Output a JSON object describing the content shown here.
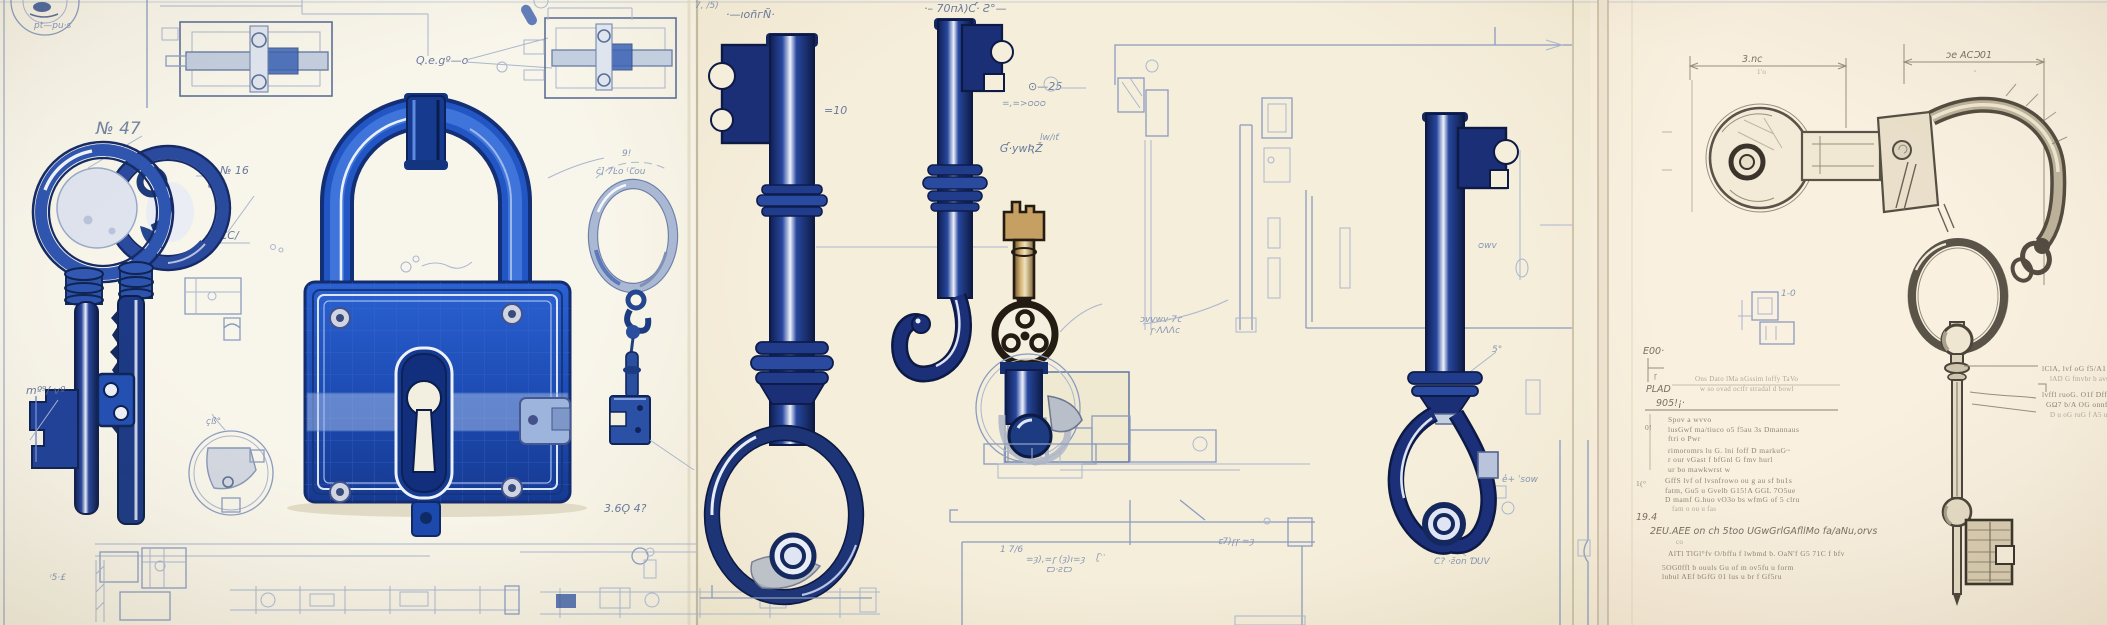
{
  "title": "Blueprint-style technical illustration of antique keys, padlock and key clasp",
  "palette": {
    "paper_left": "#f7f4ea",
    "paper_mid": "#f4edd9",
    "paper_right": "#f8efdf",
    "cobalt": "#2256c4",
    "cobalt_dark": "#16398f",
    "navy": "#1c2f74",
    "pencil_blue": "#8b9cc0",
    "pencil_dark": "#5d7096",
    "graphite": "#5a5348",
    "sepia_ink": "#241c12",
    "sepia_tan": "#c69f63"
  },
  "annotations": {
    "left": {
      "circle_note": "pt—pu·s",
      "no47": "№ 47",
      "qeg": "Q.e.gº—o",
      "no16": "№ 16",
      "occ": "‹o CC/",
      "detail_note": "çß°",
      "m2v": "mº⁹/ vº",
      "bottom_note": "ᵎ5·£"
    },
    "strip": {
      "ring_top": "c̄]·7Ŀo ⁽Ꞇou",
      "ring_mark": "9!",
      "key_tag": "3.6Ǫ 4?"
    },
    "middle": {
      "ts1": "7, /5)",
      "ts1b": "·—ıoñгÑ·",
      "ts2": "·– 70пλ)Ƈ· Ƨ°—",
      "eq10": "=10",
      "circ25": "⊙—25",
      "ouno": "=‚=>ᴑᴑᴑ",
      "cyw_top": "lw/ıť",
      "cyw": "Ɠ·ywƦŽ",
      "leader1": "ɔvvwv·7ꞇ",
      "leader2": "ꞅ·ɅɅɅϲ",
      "owv": "ᴑwv",
      "deg5": "5°",
      "esow": "e̓+ ˈsow",
      "cdov": "C? ·ƨ̈on ƊUV",
      "b1": "1 7/6",
      "b2": "=ȝ)‚=ꞅ (ȝ)ı=ȝ",
      "b3": "ꞇɔ·ƨꞇɔ",
      "b4": "ꞇ7)ꞅꞅ =ȝ",
      "b5": "ꞅ̱··"
    },
    "right": {
      "dim_left": "3.nc",
      "dim_left2": "1'o",
      "dim_right": "ɔe ACƆ01",
      "dim_tick": "ᵃ",
      "box_label": "1-0",
      "e00": "E00·",
      "dim5": "ꞅ",
      "plad": "PLAD",
      "p905": "905!¡·",
      "head1": "Ons Dato lMa nGssim loffy TaVo",
      "head2": "w so ovad octfr stradal d bowl",
      "m01": "0!",
      "para1": [
        "Spov a wvvo",
        "lusGwf ma/tiuco o5 f5au 3s Dmannaus",
        "ftri o Pwr"
      ],
      "para2": [
        "rimoromrs lu G. lni foff D markuG~",
        "r our vGast f bfGnl G fmv hurl"
      ],
      "single1": "ur bo mawkwrst w",
      "m1c": "1(°",
      "para3": [
        "GffS lvf of lvsnfrowo ou g au sf bu1s",
        "fatm, Gu5 u Gvelb G15!A GGL 7O5ue",
        "D mamf G.huo vO3o bs wfmG of 5 clru",
        "fam o ou u fas"
      ],
      "p194": "19.4",
      "peu": "2EU.AEE on ch 5too UGwGrlGAfllMo fa/aNu,orvs",
      "pco": "co",
      "patt": "AlTl TlGl°fv O/bffu f   lwbmd b. OaN'f G5 71C f bfv",
      "pbot": [
        "5OG0ffl b ouuls Gu of m ov5fu u form",
        "lubul AEf bGfG 01 lus u br f Gf5ru"
      ],
      "rkey1": "lClA, lvf oG f5/A1 n GGv",
      "rkey2": "lAD   G fmvbr b avu",
      "rkey3": "lvffl ruoG. O1f Dffll.G",
      "rkey4": "GΩ7 b/A OG onnfGvl G",
      "rkey5": "D u oG ruG f A5 u r5 A fvrn"
    }
  }
}
